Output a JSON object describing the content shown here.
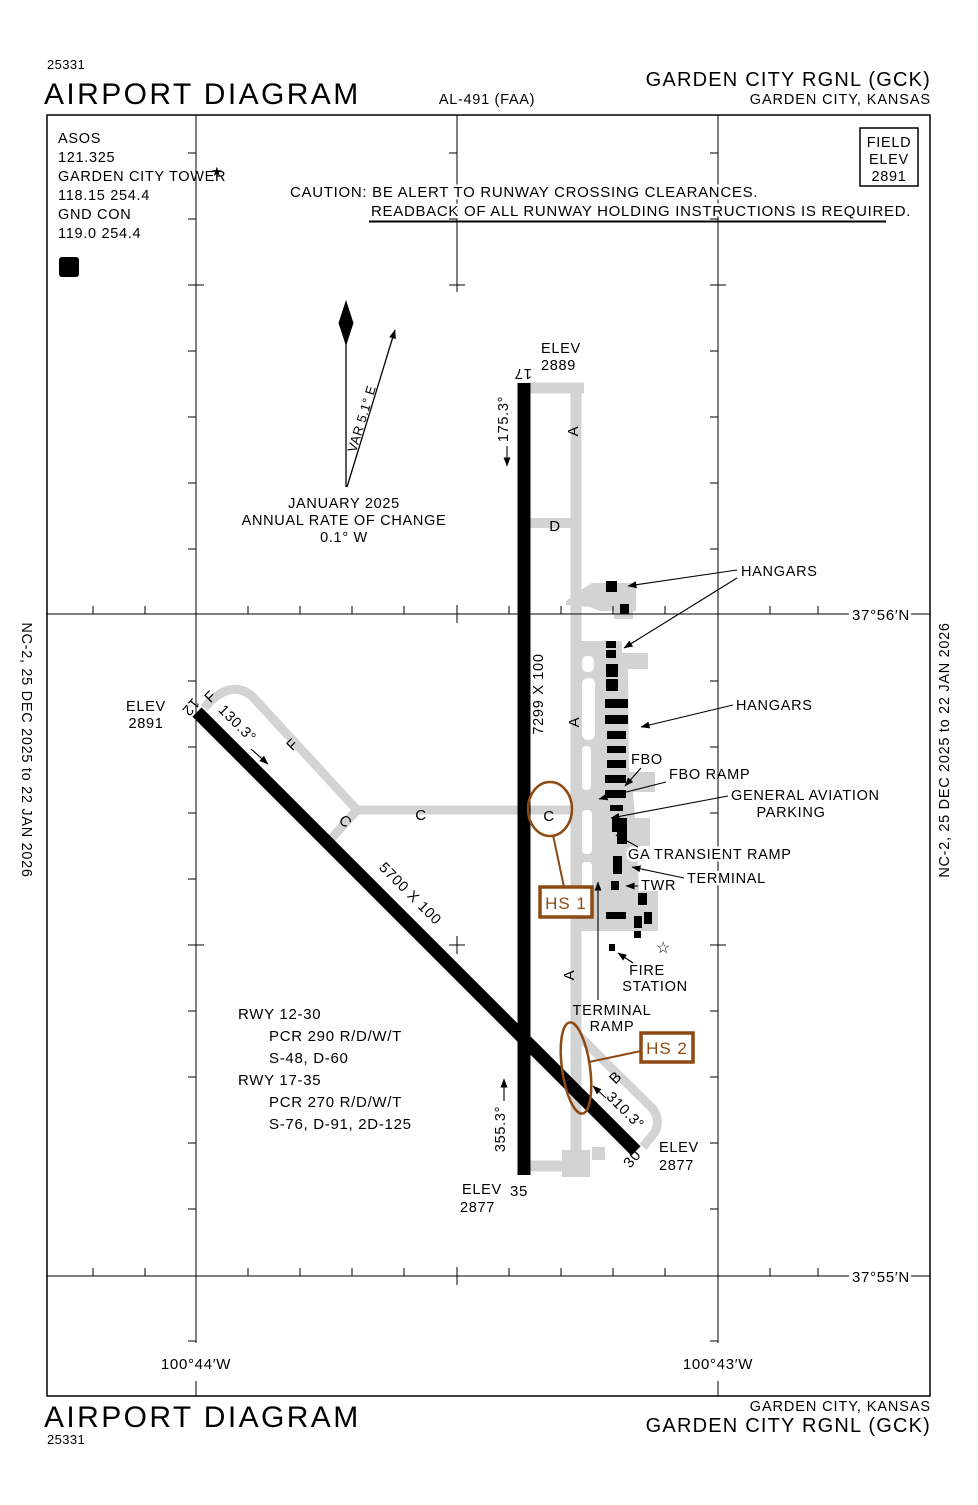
{
  "doc": {
    "chart_number": "25331",
    "title": "AIRPORT DIAGRAM",
    "al_number": "AL-491 (FAA)",
    "airport_name": "GARDEN CITY RGNL  (GCK)",
    "city": "GARDEN CITY, KANSAS",
    "edition_left": "NC-2,  25 DEC 2025  to  22 JAN 2026",
    "edition_right": "NC-2,  25 DEC 2025  to  22 JAN 2026"
  },
  "comms": {
    "asos_label": "ASOS",
    "asos_freq": "121.325",
    "tower_label": "GARDEN CITY TOWER",
    "tower_star": "★",
    "tower_freq": "118.15  254.4",
    "gnd_label": "GND CON",
    "gnd_freq": "119.0  254.4",
    "delta_symbol": "D"
  },
  "caution": {
    "line1": "CAUTION: BE ALERT TO RUNWAY CROSSING CLEARANCES.",
    "line2": "READBACK OF ALL RUNWAY HOLDING INSTRUCTIONS IS REQUIRED."
  },
  "field_elev": {
    "line1": "FIELD",
    "line2": "ELEV",
    "value": "2891"
  },
  "variation": {
    "var_label": "VAR 5.1° E",
    "date": "JANUARY 2025",
    "rate_line1": "ANNUAL RATE OF CHANGE",
    "rate_line2": "0.1° W"
  },
  "runways": {
    "elev_label": "ELEV",
    "rwy1735": {
      "dim": "7299 X 100",
      "end17": "17",
      "end35": "35",
      "hdg17": "175.3°",
      "hdg35": "355.3°",
      "elev17": "2889",
      "elev35": "2877"
    },
    "rwy1230": {
      "dim": "5700 X 100",
      "end12": "12",
      "end30": "30",
      "hdg12": "130.3°",
      "hdg30": "310.3°",
      "elev12": "2891",
      "elev30": "2877"
    }
  },
  "taxiways": {
    "a": "A",
    "b": "B",
    "c": "C",
    "d": "D",
    "f": "F"
  },
  "labels": {
    "hangars_north": "HANGARS",
    "hangars_mid": "HANGARS",
    "fbo": "FBO",
    "fbo_ramp": "FBO RAMP",
    "ga_line1": "GENERAL AVIATION",
    "ga_line2": "PARKING",
    "ga_transient": "GA TRANSIENT RAMP",
    "terminal": "TERMINAL",
    "twr": "TWR",
    "fire_line1": "FIRE",
    "fire_line2": "STATION",
    "terminal_ramp_line1": "TERMINAL",
    "terminal_ramp_line2": "RAMP",
    "beacon_star": "☆"
  },
  "hotspots": {
    "hs1": "HS 1",
    "hs2": "HS 2"
  },
  "runway_data": {
    "r1": "RWY 12-30",
    "r1_pcr": "PCR 290 R/D/W/T",
    "r1_codes": "S-48, D-60",
    "r2": "RWY 17-35",
    "r2_pcr": "PCR 270 R/D/W/T",
    "r2_codes": "S-76, D-91, 2D-125"
  },
  "graticule": {
    "lat_top": "37°56′N",
    "lat_bottom": "37°55′N",
    "lon_left": "100°44′W",
    "lon_right": "100°43′W"
  },
  "colors": {
    "ink": "#000000",
    "pavement_gray": "#d3d3d3",
    "hotspot_brown": "#8e4a12"
  }
}
